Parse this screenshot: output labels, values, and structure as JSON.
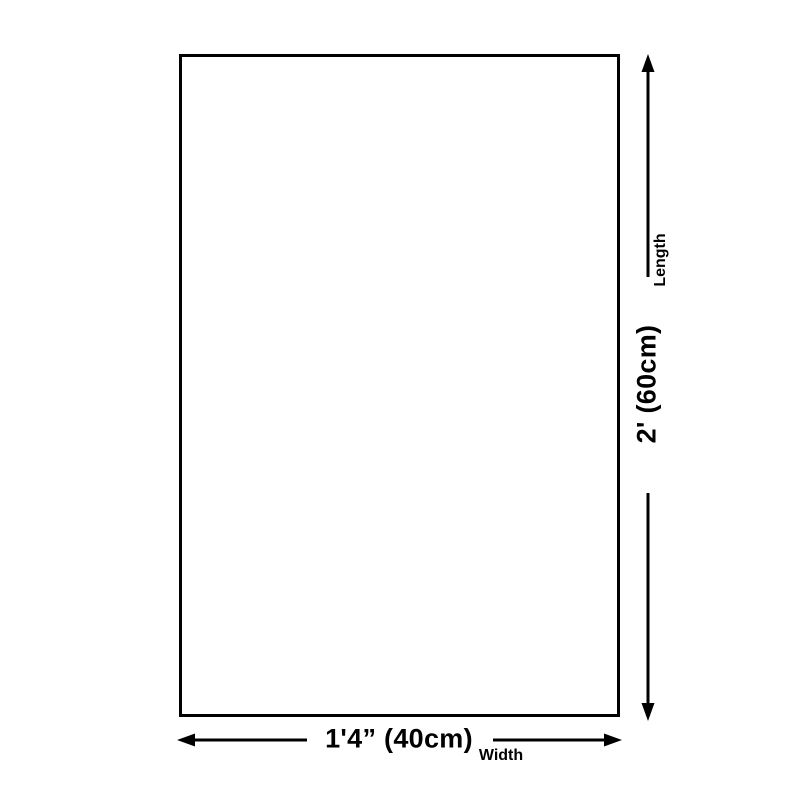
{
  "diagram": {
    "width_value": "1'4” (40cm)",
    "width_label": "Width",
    "length_value": "2' (60cm)",
    "length_label": "Length",
    "colors": {
      "line": "#000000",
      "text": "#000000",
      "background": "#ffffff"
    }
  }
}
